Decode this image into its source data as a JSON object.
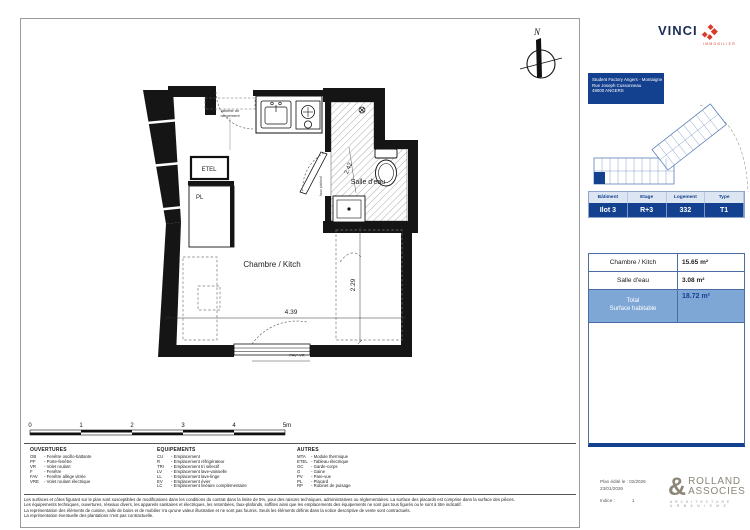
{
  "colors": {
    "navy": "#14418f",
    "light_blue": "#7fa7d6",
    "header_blue": "#dce6f2",
    "vinci_red": "#d93a2b",
    "logo_gray": "#8c8679"
  },
  "plan": {
    "room1": "Chambre / Kitch",
    "room2": "Salle d'eau",
    "dim_h": "4.39",
    "dim_v": "2.29",
    "dim_bath": "2.42",
    "tablette_1": "tablette de",
    "tablette_2": "rangement",
    "etel": "ETEL",
    "pl": "PL",
    "faux_plafond": "faux plafond",
    "window_label": "FAV+VR",
    "north": "N"
  },
  "scalebar": {
    "t0": "0",
    "t1": "1",
    "t2": "2",
    "t3": "3",
    "t4": "4",
    "t5": "5m"
  },
  "legend": {
    "ouvertures": {
      "title": "OUVERTURES",
      "items": [
        {
          "abbr": "OB",
          "label": "- Fenêtre oscillo-battante"
        },
        {
          "abbr": "PF",
          "label": "- Porte-fenêtre"
        },
        {
          "abbr": "VR",
          "label": "- Volet roulant"
        },
        {
          "abbr": "F",
          "label": "- Fenêtre"
        },
        {
          "abbr": "FAV",
          "label": "- Fenêtre allège vitrée"
        },
        {
          "abbr": "VRE",
          "label": "- Volet roulant électrique"
        }
      ]
    },
    "equipements": {
      "title": "EQUIPEMENTS",
      "items": [
        {
          "abbr": "CU",
          "label": "- Emplacement"
        },
        {
          "abbr": "R",
          "label": "- Emplacement réfrigérateur"
        },
        {
          "abbr": "TRI",
          "label": "- Emplacement tri sélectif"
        },
        {
          "abbr": "LV",
          "label": "- Emplacement lave-vaisselle"
        },
        {
          "abbr": "LL",
          "label": "- Emplacement lave-linge"
        },
        {
          "abbr": "EV",
          "label": "- Emplacement évier"
        },
        {
          "abbr": "LC",
          "label": "- Emplacement linéaire complémentaire"
        }
      ]
    },
    "autres": {
      "title": "AUTRES",
      "items": [
        {
          "abbr": "MTA",
          "label": "- Module thermique"
        },
        {
          "abbr": "ETEL",
          "label": "- Tableau électrique"
        },
        {
          "abbr": "GC",
          "label": "- Garde-corps"
        },
        {
          "abbr": "G",
          "label": "- Gaine"
        },
        {
          "abbr": "PV",
          "label": "- Pare-vue"
        },
        {
          "abbr": "PL",
          "label": "- Placard"
        },
        {
          "abbr": "RP",
          "label": "- Robinet de puisage"
        }
      ]
    }
  },
  "disclaimer": {
    "lines": [
      "Les surfaces et côtes figurant sur le plan sont susceptibles de modifications dans les conditions du contrat dans la limite de 5%, pour des raisons techniques, administratives ou réglementaires. La surface des placards est comprise dans la surface des pièces.",
      "Les équipements techniques, ouvertures, réseaux divers, les appareils sanitaires et électriques, les retombées, faux-plafonds, soffites ainsi que les emplacements des équipements ne sont pas tous figurés ou le sont à titre indicatif.",
      "La représentation des éléments de cuisine, salle de bains et de mobilier n'a qu'une valeur illustrative et ne sont pas fournis. Seuls les éléments définis dans la notice descriptive de vente sont contractuels.",
      "La représentation éventuelle des plantations n'est pas contractuelle."
    ]
  },
  "panel": {
    "vinci": {
      "wordmark": "VINCI",
      "sub": "IMMOBILIER"
    },
    "address": {
      "line1": "Student Factory Angers - Montaigne",
      "line2": "Rue Joseph Cussonneau",
      "line3": "49000 ANGERS"
    },
    "unit_table": {
      "headers": [
        "Bâtiment",
        "Etage",
        "Logement",
        "Type"
      ],
      "values": [
        "Ilot 3",
        "R+3",
        "332",
        "T1"
      ]
    },
    "surface_table": {
      "rows": [
        {
          "label": "Chambre / Kitch",
          "value": "15.65 m²"
        },
        {
          "label": "Salle d'eau",
          "value": "3.08 m²"
        }
      ],
      "total_line1": "Total",
      "total_line2": "Surface habitable",
      "total_value": "18.72 m²"
    },
    "edition": {
      "line1": "Plan édité le : 02/2026",
      "line2": "23/01/2026",
      "indice_label": "Indice :",
      "indice_value": "1"
    },
    "rolland": {
      "amp": "&",
      "name1": "ROLLAND",
      "name2": "ASSOCIES",
      "sub1": "ARCHITECTURE",
      "sub2": "URBANISME"
    }
  }
}
